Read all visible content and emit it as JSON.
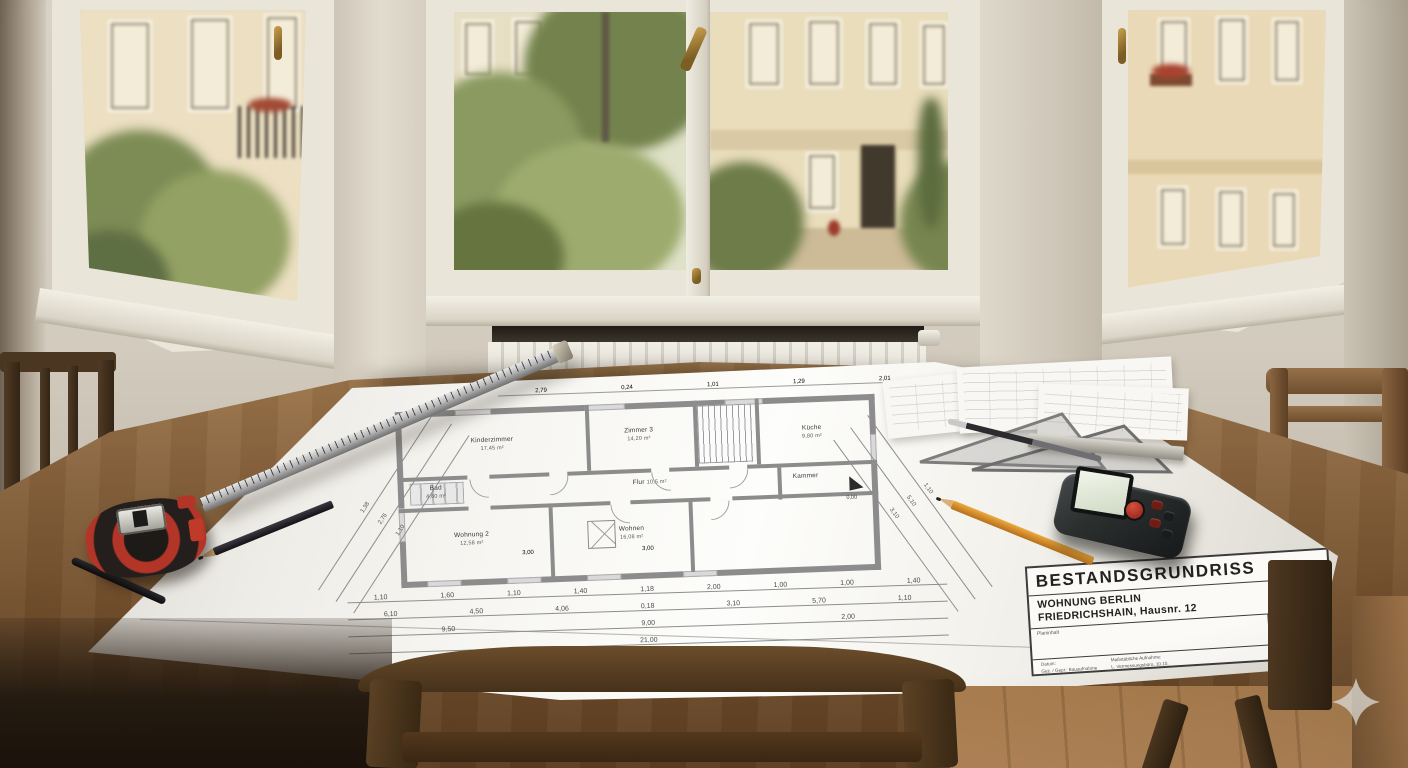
{
  "scene": {
    "description": "Architectural existing-floor-plan drawing on a wooden table in front of three windows, Berlin apartment",
    "objects": [
      "steel-ruler",
      "black-pencil",
      "black-pen",
      "tape-measure",
      "orange-pencil",
      "laser-distance-meter",
      "set-squares",
      "mechanical-pencil",
      "sketch-papers",
      "wooden-chairs",
      "radiator"
    ],
    "colors": {
      "wall": "#d3ccc0",
      "paper": "#f5f4f0",
      "table_wood": "#80603c",
      "tape_measure_red": "#b23527",
      "pencil_orange": "#d78f2f",
      "laser_body": "#2b2e2d",
      "plan_wall_gray": "#8c8c8c"
    }
  },
  "blueprint": {
    "title_block": {
      "title": "BESTANDSGRUNDRISS",
      "line1": "WOHNUNG BERLIN",
      "line2": "FRIEDRICHSHAIN, Hausnr. 12",
      "field_label": "Planinhalt",
      "sheet_label": "Blatt",
      "sheet": "A1",
      "footer_left_label": "Datum:",
      "footer_left_value": "Gez. / Gepr.: Bauaufnahme",
      "footer_right_label": "Maßstäbliche Aufnahme:",
      "footer_right_value": "L. Vermessungsbüro, 10.10."
    },
    "rooms": [
      {
        "name": "Kinderzimmer",
        "area": "17,45 m²"
      },
      {
        "name": "Zimmer 3",
        "area": "14,20 m²"
      },
      {
        "name": "Küche",
        "area": "9,80 m²"
      },
      {
        "name": "Bad",
        "area": "4,60 m²"
      },
      {
        "name": "Flur",
        "area": "10,5 m²"
      },
      {
        "name": "Kammer",
        "area": "2,10 m²"
      },
      {
        "name": "Wohnung 2",
        "area": "12,58 m²"
      },
      {
        "name": "Wohnen",
        "area": "16,08 m²"
      }
    ],
    "dims": {
      "top": [
        "2,79",
        "0,24",
        "1,01",
        "1,29",
        "2,01"
      ],
      "under": [
        "3,00",
        "3,00"
      ],
      "row1": [
        "1,10",
        "1,60",
        "1,10",
        "1,40",
        "1,18",
        "2,00",
        "1,00",
        "1,00",
        "1,40"
      ],
      "row2": [
        "6,10",
        "4,50",
        "4,06",
        "0,18",
        "3,10",
        "5,70",
        "1,10"
      ],
      "row3": [
        "9,50",
        "9,00",
        "2,00"
      ],
      "total": "21,00",
      "left": [
        "1,38",
        "2,76",
        "1,10"
      ],
      "right": [
        "1,10",
        "5,10",
        "3,10"
      ],
      "entry_level": "0,00"
    }
  }
}
